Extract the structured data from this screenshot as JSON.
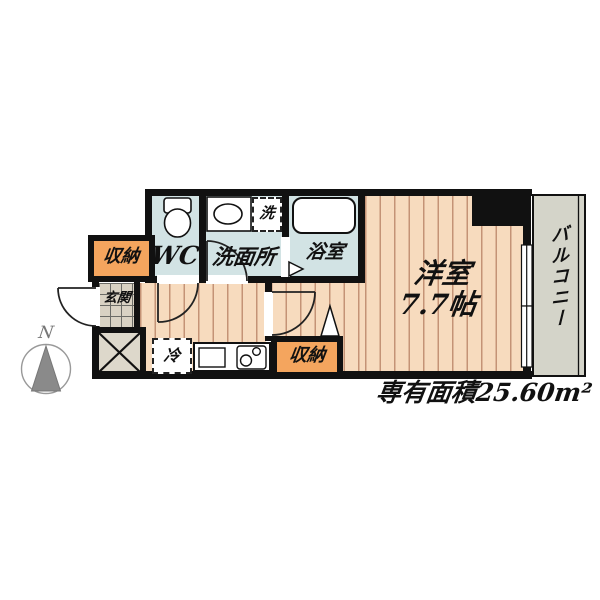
{
  "plan": {
    "rooms": {
      "closet_top": {
        "label": "収納"
      },
      "wc": {
        "label": "WC"
      },
      "washroom": {
        "label": "洗面所"
      },
      "washer": {
        "label": "洗"
      },
      "bath": {
        "label": "浴室"
      },
      "genkan": {
        "label": "玄関"
      },
      "fridge": {
        "label": "冷"
      },
      "closet_bottom": {
        "label": "収納"
      },
      "main_room": {
        "name_label": "洋室",
        "size_label": "7.7帖"
      },
      "balcony": {
        "label": "バルコニー"
      }
    },
    "annotations": {
      "area_label": "専有面積25.60m²",
      "compass_north": "N"
    },
    "colors": {
      "wall": "#111111",
      "floor": "#f7dbbe",
      "floor_stripe": "#c49376",
      "wet_room": "#d2e3e4",
      "storage": "#f4a55e",
      "genkan_tile": "#d9d2c3",
      "balcony": "#d4d4c9",
      "shaft": "#ddd8cb",
      "compass_gray": "#8a8a8a"
    }
  }
}
